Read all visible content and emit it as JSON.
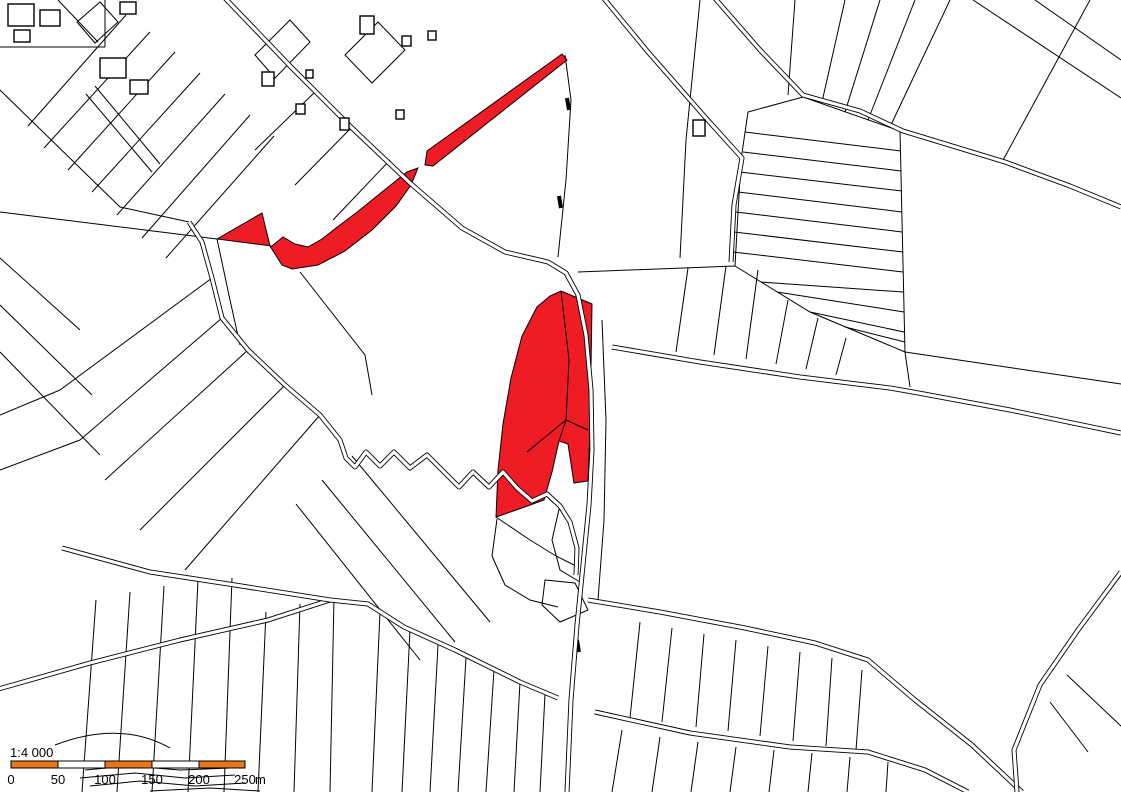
{
  "map": {
    "background": "#ffffff",
    "line_color": "#000000",
    "highlight_color": "#ee1c25",
    "red_parcels": [
      {
        "name": "highlighted-parcel-west",
        "path": "M217,239 L262,213 L270,246 L282,265 L292,269 L318,265 L345,251 L372,230 L396,206 L411,185 L418,168 L407,172 L382,192 L356,213 L336,228 L322,239 L308,247 L295,244 L283,237 L272,246 Z"
      },
      {
        "name": "highlighted-parcel-central",
        "path": "M561,291 L592,304 L590,430 L588,481 L574,483 L568,444 L559,441 L552,472 L544,500 L519,509 L496,517 L498,470 L503,424 L511,378 L522,336 L537,307 L550,296 Z"
      },
      {
        "name": "highlighted-parcel-strip",
        "path": "M425,165 L427,151 L562,54 L567,60 L433,166 Z"
      }
    ]
  },
  "scale_bar": {
    "ratio_text": "1:4 000",
    "bar_color": "#e8761b",
    "tick_labels": [
      "0",
      "50",
      "100",
      "150",
      "200",
      "250"
    ],
    "unit": "m"
  }
}
